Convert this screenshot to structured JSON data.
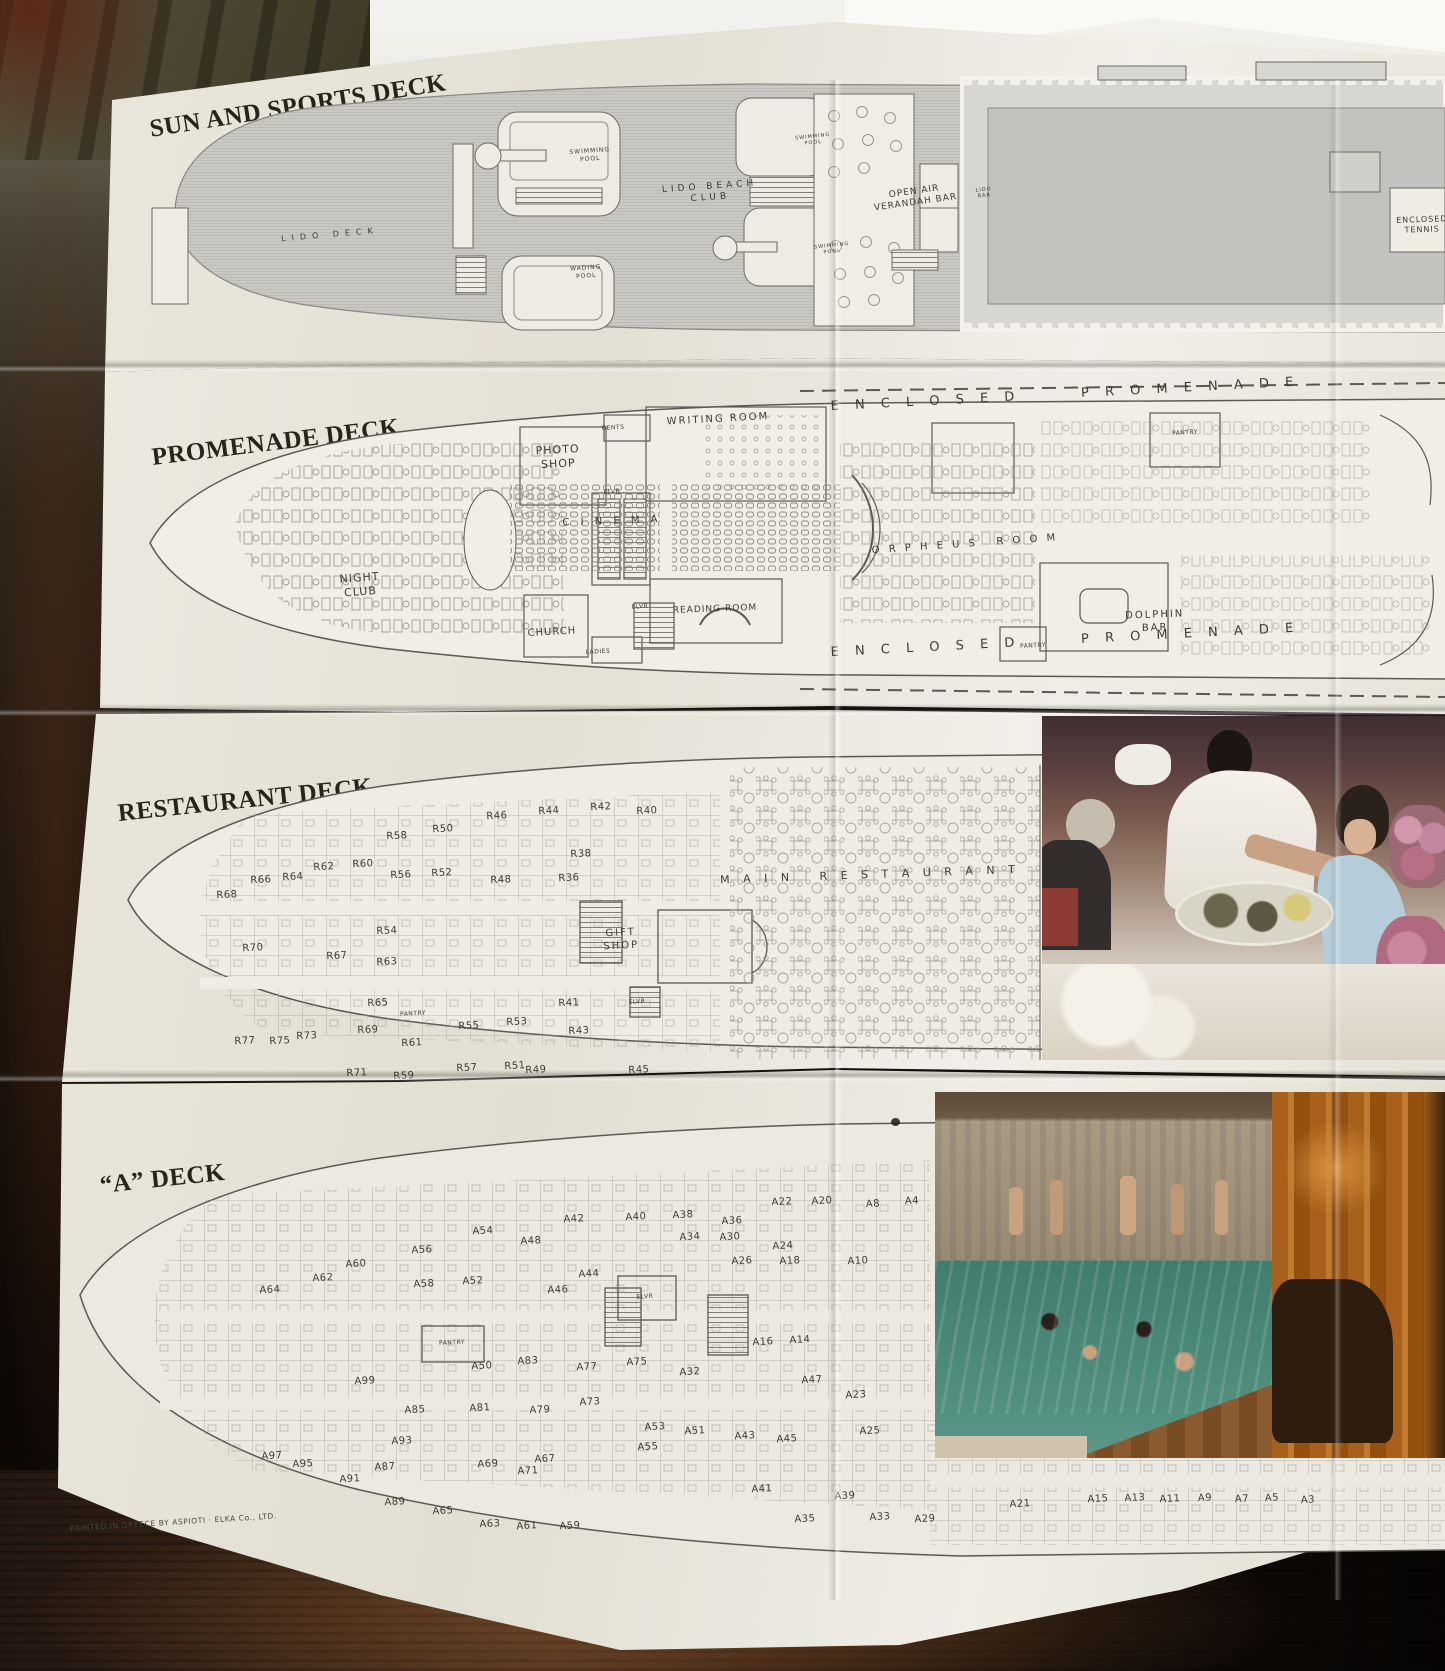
{
  "colors": {
    "paper": "#eae7dd",
    "paper_bright": "#f1efe8",
    "backing_white": "#f4f3ef",
    "hull_gray": "#c9c8c3",
    "hull_line": "#bcbbb5",
    "plan_line": "#5b5953",
    "title_ink": "#272419",
    "label_ink": "#46433b",
    "table_wood_dark": "#21150d",
    "table_wood_mid": "#3f2818",
    "pool_water": "#477f70",
    "sauna_wood": "#b06a24"
  },
  "titles": {
    "deck1": "SUN AND SPORTS DECK",
    "deck2": "PROMENADE DECK",
    "deck3": "RESTAURANT DECK",
    "deck4": "“A” DECK"
  },
  "footer": {
    "printed_note": "PRINTED IN GREECE BY ASPIOTI · ELKA Co., LTD."
  },
  "decks": {
    "sun": {
      "labels": [
        {
          "t": "LIDO DECK",
          "x": 180,
          "y": 175,
          "s": 8,
          "sp": 6,
          "r": -5,
          "n": "label-lido-deck"
        },
        {
          "t": "SWIMMING\nPOOL",
          "x": 440,
          "y": 95,
          "s": 6,
          "sp": 1,
          "r": -4,
          "n": "label-swimming-pool"
        },
        {
          "t": "WADING\nPOOL",
          "x": 436,
          "y": 212,
          "s": 6,
          "sp": 1,
          "r": -4,
          "n": "label-wading-pool"
        },
        {
          "t": "LIDO BEACH\nCLUB",
          "x": 560,
          "y": 133,
          "s": 9,
          "sp": 4,
          "r": -4,
          "n": "label-lido-beach-club"
        },
        {
          "t": "SWIMMING\nPOOL",
          "x": 663,
          "y": 80,
          "s": 5,
          "sp": 1,
          "r": -6,
          "n": "label-swimming-pool"
        },
        {
          "t": "SWIMMING\nPOOL",
          "x": 682,
          "y": 189,
          "s": 5,
          "sp": 1,
          "r": -6,
          "n": "label-swimming-pool"
        },
        {
          "t": "OPEN AIR\nVERANDAH BAR",
          "x": 765,
          "y": 138,
          "s": 9,
          "sp": 1,
          "r": -8,
          "n": "label-open-air-verandah-bar"
        },
        {
          "t": "LIDO\nBAR",
          "x": 834,
          "y": 133,
          "s": 5,
          "sp": 1,
          "r": -6,
          "n": "label-lido-bar"
        },
        {
          "t": "ENCLOSED\nTENNIS",
          "x": 1272,
          "y": 165,
          "s": 8,
          "sp": 1,
          "r": -2,
          "n": "label-enclosed-tennis"
        }
      ]
    },
    "promenade": {
      "labels": [
        {
          "t": "E N C L O S E D      P R O M E N A D E",
          "x": 925,
          "y": 20,
          "s": 13,
          "sp": 6,
          "r": -3,
          "n": "label-enclosed-promenade-top"
        },
        {
          "t": "WRITING ROOM",
          "x": 578,
          "y": 45,
          "s": 10,
          "sp": 2,
          "r": -3,
          "n": "label-writing-room"
        },
        {
          "t": "GENTS",
          "x": 473,
          "y": 53,
          "s": 6,
          "r": -3,
          "n": "label-gents"
        },
        {
          "t": "PHOTO\nSHOP",
          "x": 418,
          "y": 82,
          "s": 11,
          "sp": 1,
          "r": -3,
          "n": "label-photo-shop"
        },
        {
          "t": "ELVR",
          "x": 472,
          "y": 117,
          "s": 6,
          "r": -3,
          "n": "label-elevator"
        },
        {
          "t": "PANTRY",
          "x": 1045,
          "y": 58,
          "s": 6,
          "r": -3,
          "n": "label-pantry"
        },
        {
          "t": "C I N E M A",
          "x": 472,
          "y": 147,
          "s": 10,
          "sp": 4,
          "r": -2,
          "n": "label-cinema"
        },
        {
          "t": "NIGHT\nCLUB",
          "x": 220,
          "y": 210,
          "s": 11,
          "sp": 1,
          "r": -4,
          "n": "label-night-club"
        },
        {
          "t": "O R P H E U S   R O O M",
          "x": 825,
          "y": 170,
          "s": 10,
          "sp": 3,
          "r": -4,
          "n": "label-orpheus-room"
        },
        {
          "t": "ELVR",
          "x": 500,
          "y": 232,
          "s": 6,
          "r": -3,
          "n": "label-elevator"
        },
        {
          "t": "CHURCH",
          "x": 412,
          "y": 258,
          "s": 10,
          "sp": 1,
          "r": -3,
          "n": "label-church"
        },
        {
          "t": "LADIES",
          "x": 458,
          "y": 277,
          "s": 6,
          "r": -3,
          "n": "label-ladies"
        },
        {
          "t": "READING ROOM",
          "x": 575,
          "y": 235,
          "s": 9,
          "sp": 1,
          "r": -2,
          "n": "label-reading-room"
        },
        {
          "t": "DOLPHIN\nBAR",
          "x": 1015,
          "y": 247,
          "s": 10,
          "sp": 2,
          "r": -2,
          "n": "label-dolphin-bar"
        },
        {
          "t": "PANTRY",
          "x": 893,
          "y": 271,
          "s": 6,
          "r": -3,
          "n": "label-pantry"
        },
        {
          "t": "E N C L O S E D      P R O M E N A D E",
          "x": 925,
          "y": 266,
          "s": 13,
          "sp": 6,
          "r": -3,
          "n": "label-enclosed-promenade-bottom"
        }
      ]
    },
    "restaurant": {
      "labels": [
        {
          "t": "R68",
          "x": 117,
          "y": 181
        },
        {
          "t": "R66",
          "x": 151,
          "y": 166
        },
        {
          "t": "R64",
          "x": 183,
          "y": 163
        },
        {
          "t": "R62",
          "x": 214,
          "y": 153
        },
        {
          "t": "R60",
          "x": 253,
          "y": 150
        },
        {
          "t": "R58",
          "x": 287,
          "y": 122
        },
        {
          "t": "R56",
          "x": 291,
          "y": 161
        },
        {
          "t": "R54",
          "x": 277,
          "y": 217
        },
        {
          "t": "R52",
          "x": 332,
          "y": 159
        },
        {
          "t": "R50",
          "x": 333,
          "y": 115
        },
        {
          "t": "R48",
          "x": 391,
          "y": 166
        },
        {
          "t": "R46",
          "x": 387,
          "y": 102
        },
        {
          "t": "R44",
          "x": 439,
          "y": 97
        },
        {
          "t": "R42",
          "x": 491,
          "y": 93
        },
        {
          "t": "R40",
          "x": 537,
          "y": 97
        },
        {
          "t": "R38",
          "x": 471,
          "y": 140
        },
        {
          "t": "R36",
          "x": 459,
          "y": 164
        },
        {
          "t": "R70",
          "x": 143,
          "y": 234
        },
        {
          "t": "R67",
          "x": 227,
          "y": 242
        },
        {
          "t": "R63",
          "x": 277,
          "y": 248
        },
        {
          "t": "R65",
          "x": 268,
          "y": 289
        },
        {
          "t": "R69",
          "x": 258,
          "y": 316
        },
        {
          "t": "R61",
          "x": 302,
          "y": 329
        },
        {
          "t": "R59",
          "x": 294,
          "y": 362
        },
        {
          "t": "R57",
          "x": 357,
          "y": 354
        },
        {
          "t": "R55",
          "x": 359,
          "y": 312
        },
        {
          "t": "R53",
          "x": 407,
          "y": 308
        },
        {
          "t": "R51",
          "x": 405,
          "y": 352
        },
        {
          "t": "R49",
          "x": 426,
          "y": 356
        },
        {
          "t": "R45",
          "x": 529,
          "y": 356
        },
        {
          "t": "R43",
          "x": 469,
          "y": 317
        },
        {
          "t": "R41",
          "x": 459,
          "y": 289
        },
        {
          "t": "R71",
          "x": 247,
          "y": 359
        },
        {
          "t": "R73",
          "x": 197,
          "y": 322
        },
        {
          "t": "R75",
          "x": 170,
          "y": 327
        },
        {
          "t": "R77",
          "x": 135,
          "y": 327
        },
        {
          "t": "PANTRY",
          "x": 303,
          "y": 299,
          "s": 6,
          "n": "label-pantry"
        },
        {
          "t": "ELVR",
          "x": 527,
          "y": 287,
          "s": 6,
          "n": "label-elevator"
        },
        {
          "t": "GIFT\nSHOP",
          "x": 511,
          "y": 225,
          "s": 10,
          "sp": 2,
          "r": -3,
          "n": "label-gift-shop"
        },
        {
          "t": "M A I N   R E S T A U R A N T",
          "x": 760,
          "y": 160,
          "s": 11,
          "sp": 5,
          "r": -2,
          "n": "label-main-restaurant"
        }
      ]
    },
    "adeck": {
      "labels": [
        {
          "t": "A64",
          "x": 210,
          "y": 211
        },
        {
          "t": "A62",
          "x": 263,
          "y": 199
        },
        {
          "t": "A60",
          "x": 296,
          "y": 185
        },
        {
          "t": "A58",
          "x": 364,
          "y": 205
        },
        {
          "t": "A56",
          "x": 362,
          "y": 171
        },
        {
          "t": "A54",
          "x": 423,
          "y": 152
        },
        {
          "t": "A52",
          "x": 413,
          "y": 202
        },
        {
          "t": "A50",
          "x": 422,
          "y": 287
        },
        {
          "t": "A48",
          "x": 471,
          "y": 162
        },
        {
          "t": "A46",
          "x": 498,
          "y": 211
        },
        {
          "t": "A44",
          "x": 529,
          "y": 195
        },
        {
          "t": "A42",
          "x": 514,
          "y": 140
        },
        {
          "t": "A40",
          "x": 576,
          "y": 138
        },
        {
          "t": "A38",
          "x": 623,
          "y": 136
        },
        {
          "t": "A36",
          "x": 672,
          "y": 142
        },
        {
          "t": "A34",
          "x": 630,
          "y": 158
        },
        {
          "t": "A30",
          "x": 670,
          "y": 158
        },
        {
          "t": "A26",
          "x": 682,
          "y": 182
        },
        {
          "t": "A24",
          "x": 723,
          "y": 167
        },
        {
          "t": "A22",
          "x": 722,
          "y": 123
        },
        {
          "t": "A20",
          "x": 762,
          "y": 122
        },
        {
          "t": "A18",
          "x": 730,
          "y": 182
        },
        {
          "t": "A16",
          "x": 703,
          "y": 263
        },
        {
          "t": "A14",
          "x": 740,
          "y": 261
        },
        {
          "t": "A10",
          "x": 798,
          "y": 182
        },
        {
          "t": "A8",
          "x": 813,
          "y": 125
        },
        {
          "t": "A4",
          "x": 852,
          "y": 122
        },
        {
          "t": "A2",
          "x": 885,
          "y": 120
        },
        {
          "t": "A99",
          "x": 305,
          "y": 302
        },
        {
          "t": "A97",
          "x": 212,
          "y": 377
        },
        {
          "t": "A95",
          "x": 243,
          "y": 385
        },
        {
          "t": "A93",
          "x": 342,
          "y": 362
        },
        {
          "t": "A91",
          "x": 290,
          "y": 400
        },
        {
          "t": "A89",
          "x": 335,
          "y": 423
        },
        {
          "t": "A87",
          "x": 325,
          "y": 388
        },
        {
          "t": "A85",
          "x": 355,
          "y": 331
        },
        {
          "t": "A83",
          "x": 468,
          "y": 282
        },
        {
          "t": "A81",
          "x": 420,
          "y": 329
        },
        {
          "t": "A79",
          "x": 480,
          "y": 331
        },
        {
          "t": "A77",
          "x": 527,
          "y": 288
        },
        {
          "t": "A75",
          "x": 577,
          "y": 283
        },
        {
          "t": "A73",
          "x": 530,
          "y": 323
        },
        {
          "t": "A71",
          "x": 468,
          "y": 392
        },
        {
          "t": "A69",
          "x": 428,
          "y": 385
        },
        {
          "t": "A67",
          "x": 485,
          "y": 380
        },
        {
          "t": "A65",
          "x": 383,
          "y": 432
        },
        {
          "t": "A63",
          "x": 430,
          "y": 445
        },
        {
          "t": "A61",
          "x": 467,
          "y": 447
        },
        {
          "t": "A59",
          "x": 510,
          "y": 447
        },
        {
          "t": "A55",
          "x": 588,
          "y": 368
        },
        {
          "t": "A53",
          "x": 595,
          "y": 348
        },
        {
          "t": "A51",
          "x": 635,
          "y": 352
        },
        {
          "t": "A47",
          "x": 752,
          "y": 301
        },
        {
          "t": "A45",
          "x": 727,
          "y": 360
        },
        {
          "t": "A43",
          "x": 685,
          "y": 357
        },
        {
          "t": "A41",
          "x": 702,
          "y": 410
        },
        {
          "t": "A39",
          "x": 785,
          "y": 417
        },
        {
          "t": "A35",
          "x": 745,
          "y": 440
        },
        {
          "t": "A33",
          "x": 820,
          "y": 438
        },
        {
          "t": "A32",
          "x": 630,
          "y": 293
        },
        {
          "t": "A29",
          "x": 865,
          "y": 440
        },
        {
          "t": "A25",
          "x": 810,
          "y": 352
        },
        {
          "t": "A23",
          "x": 796,
          "y": 316
        },
        {
          "t": "A21",
          "x": 960,
          "y": 425
        },
        {
          "t": "A15",
          "x": 1038,
          "y": 420
        },
        {
          "t": "A13",
          "x": 1075,
          "y": 419
        },
        {
          "t": "A11",
          "x": 1110,
          "y": 420
        },
        {
          "t": "A9",
          "x": 1145,
          "y": 419
        },
        {
          "t": "A7",
          "x": 1182,
          "y": 420
        },
        {
          "t": "A5",
          "x": 1212,
          "y": 419
        },
        {
          "t": "A3",
          "x": 1248,
          "y": 421
        },
        {
          "t": "PANTRY",
          "x": 392,
          "y": 263,
          "s": 6,
          "n": "label-pantry"
        },
        {
          "t": "ELVR",
          "x": 585,
          "y": 217,
          "s": 6,
          "n": "label-elevator"
        }
      ]
    }
  }
}
